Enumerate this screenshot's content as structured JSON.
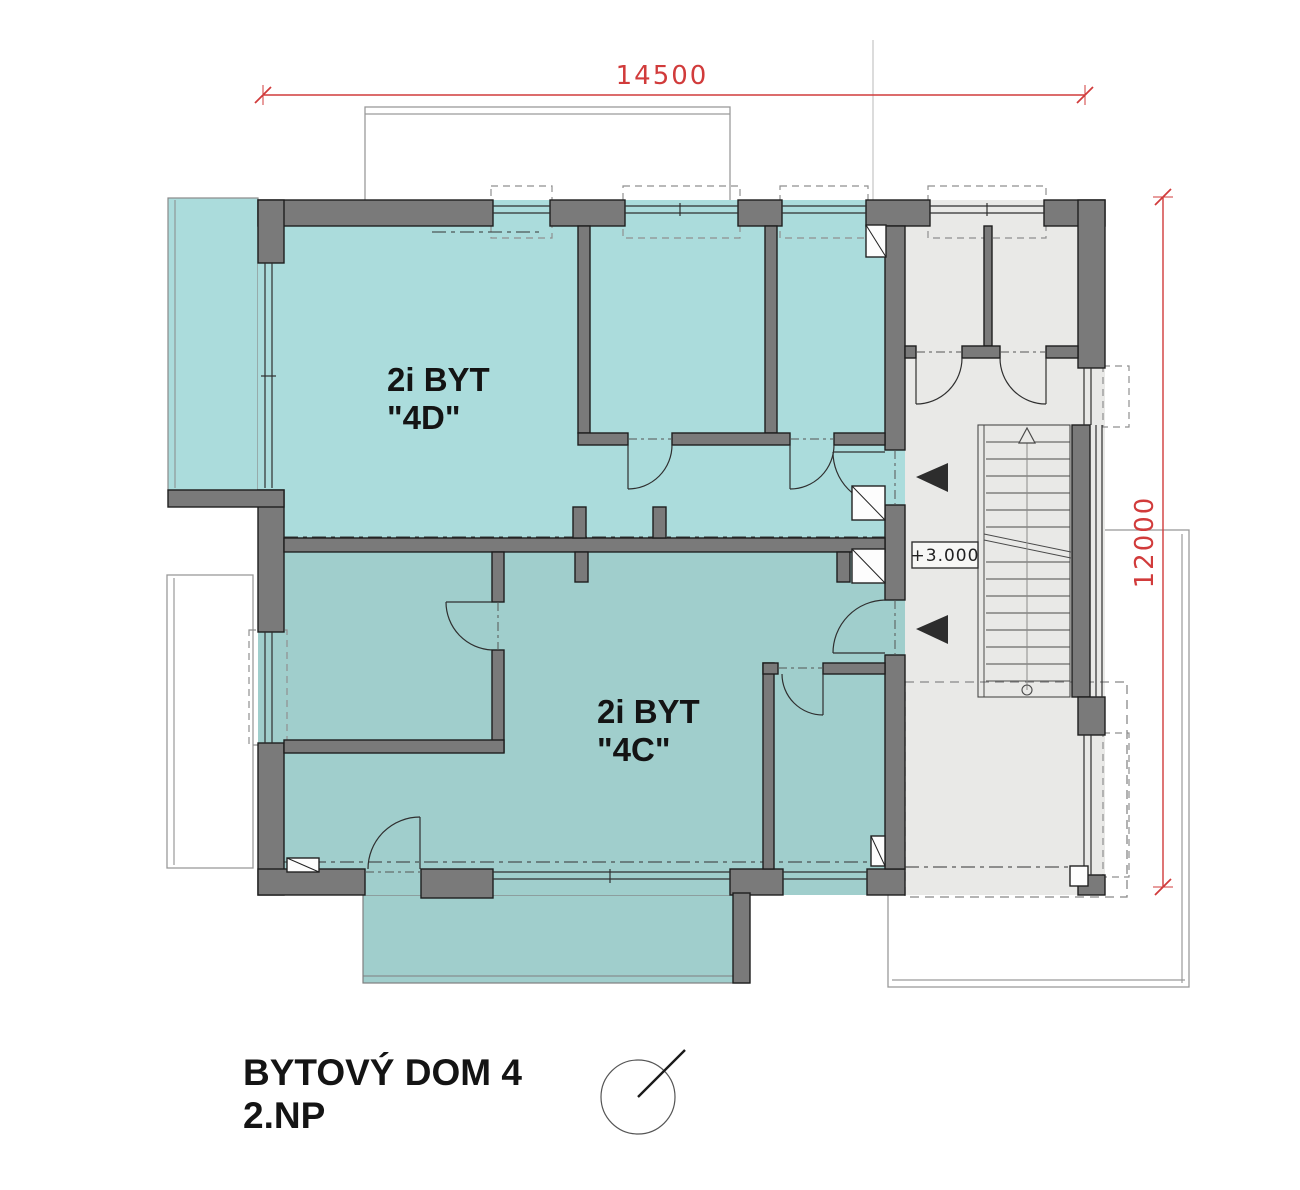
{
  "title_block": {
    "title": "BYTOVÝ DOM 4",
    "floor": "2.NP"
  },
  "dimensions": {
    "width_label": "14500",
    "height_label": "12000"
  },
  "apartments": [
    {
      "id": "4D",
      "label_line1": "2i BYT",
      "label_line2": "\"4D\"",
      "fill": "#abdcdc"
    },
    {
      "id": "4C",
      "label_line1": "2i BYT",
      "label_line2": "\"4C\"",
      "fill": "#a0cecc"
    }
  ],
  "level_marker": {
    "value": "+3.000"
  },
  "staircase": {
    "direction": "up",
    "floor_fill": "#e9e9e7"
  },
  "symbols": {
    "north_arrow": "north-arrow",
    "entry_arrows": 2,
    "vent_shafts": 5
  },
  "colors": {
    "wall_fill": "#7a7a7a",
    "outline": "#1e1e1e",
    "apartment_4d_fill": "#abdcdc",
    "apartment_4c_fill": "#a0cecc",
    "balcony_4d_fill": "#abdcdc",
    "balcony_4c_fill": "#a0cecc",
    "staircase_fill": "#e9e9e7",
    "dimension_red": "#d13b3b",
    "background": "#ffffff"
  }
}
